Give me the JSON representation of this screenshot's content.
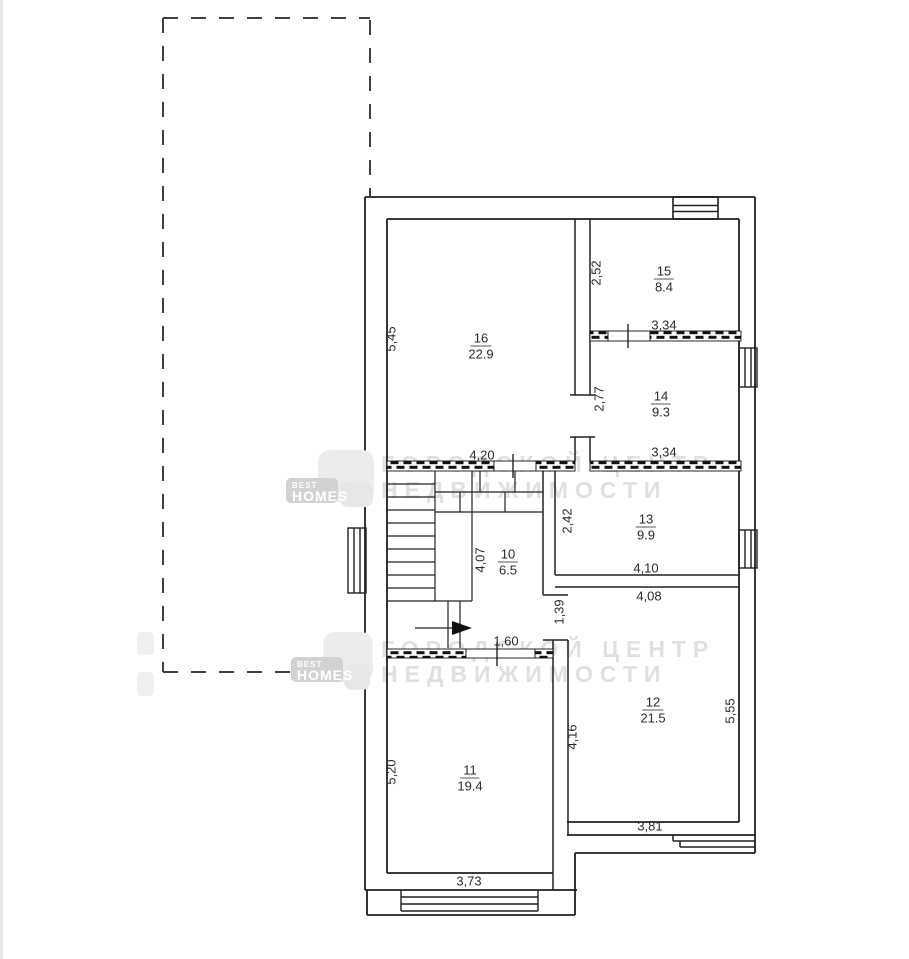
{
  "plan_title": "floor-plan",
  "rooms": [
    {
      "number": "16",
      "area": "22.9"
    },
    {
      "number": "15",
      "area": "8.4"
    },
    {
      "number": "14",
      "area": "9.3"
    },
    {
      "number": "13",
      "area": "9.9"
    },
    {
      "number": "10",
      "area": "6.5"
    },
    {
      "number": "12",
      "area": "21.5"
    },
    {
      "number": "11",
      "area": "19.4"
    }
  ],
  "dimensions": [
    {
      "text": "5,45"
    },
    {
      "text": "2,52"
    },
    {
      "text": "3,34"
    },
    {
      "text": "2,77"
    },
    {
      "text": "3,34"
    },
    {
      "text": "4,20"
    },
    {
      "text": "2,42"
    },
    {
      "text": "4,07"
    },
    {
      "text": "4,10"
    },
    {
      "text": "4,08"
    },
    {
      "text": "1,39"
    },
    {
      "text": "1,60"
    },
    {
      "text": "4,16"
    },
    {
      "text": "5,55"
    },
    {
      "text": "5,20"
    },
    {
      "text": "3,81"
    },
    {
      "text": "3,73"
    }
  ],
  "watermarks": {
    "agency_line1": "ГОРОДСКОЙ ЦЕНТР",
    "agency_line2": "НЕДВИЖИМОСТИ",
    "logo_top": "BEST",
    "logo_bottom": "HOMES"
  },
  "colors": {
    "line": "#202020",
    "dash": "#3f3f3f",
    "watermark_text": "#e0e0e0",
    "logo_plate": "#d2d2d2",
    "logo_square": "#ececec"
  }
}
